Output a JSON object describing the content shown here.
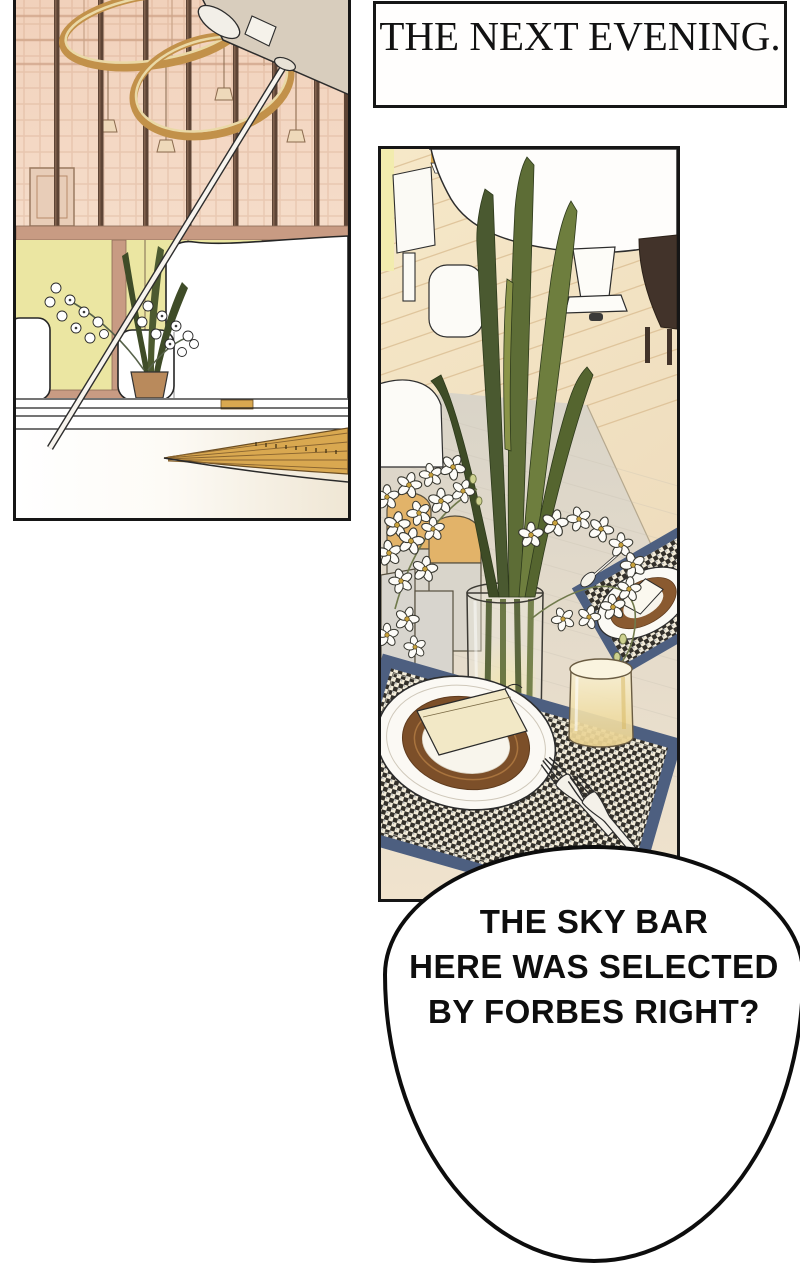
{
  "page": {
    "kind": "webtoon-comic-page",
    "background_color": "#ffffff"
  },
  "caption_box": {
    "text": "THE NEXT EVENING."
  },
  "speech_bubble": {
    "lines": [
      "THE SKY BAR",
      "HERE WAS SELECTED",
      "BY FORBES RIGHT?"
    ]
  },
  "panels": {
    "panel_1": {
      "alt": "sky-bar interior: hanging lamp rings, window mullions, white sofa, orchid pot, open grand piano lid"
    },
    "panel_2": {
      "alt": "dining table: orchid centerpiece in glass vase, candles, houndstooth placemats, plates, napkins, glass, white grand piano"
    }
  },
  "colors": {
    "panel_border": "#161616",
    "gold_ring": "#c2914a",
    "window_glass": "#ebe6a2",
    "wall_peach": "#f2d3bd",
    "leaf_green": "#55652f",
    "placemat_navy": "#4d5f80",
    "charger_brown": "#7c4f29",
    "floor_tan": "#ecd9ba",
    "candle_tan": "#e2b369",
    "napkin_cream": "#f2e8c6"
  }
}
